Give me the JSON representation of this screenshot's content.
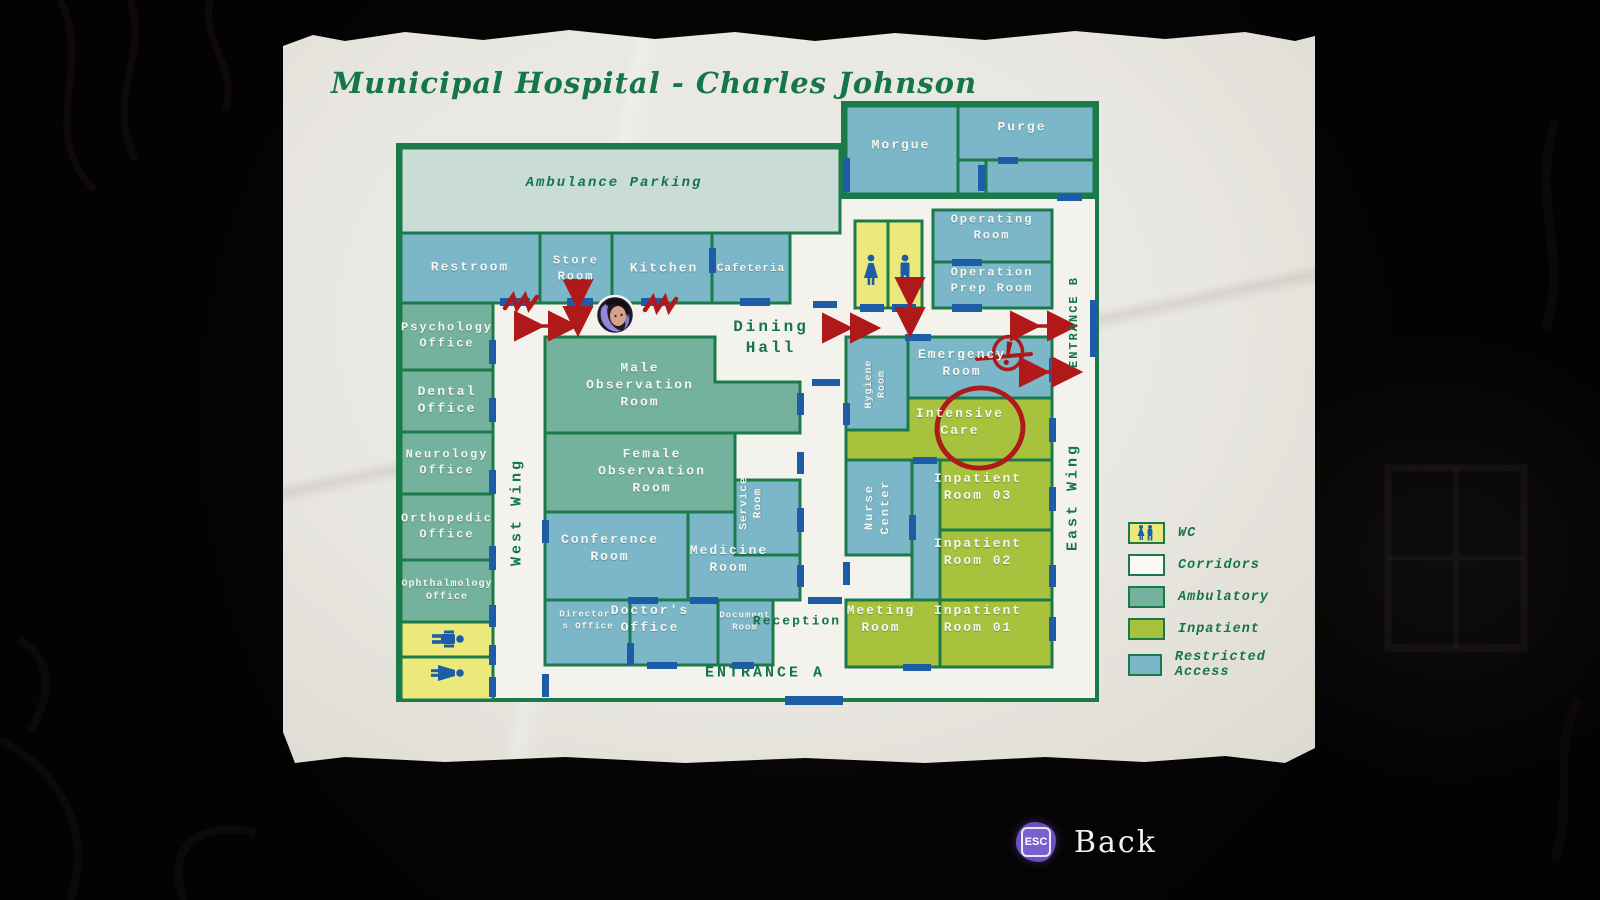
{
  "title": "Municipal Hospital - Charles Johnson",
  "map": {
    "ambulance_parking": "Ambulance Parking",
    "restroom": "Restroom",
    "store_room": "Store\nRoom",
    "kitchen": "Kitchen",
    "cafeteria": "Cafeteria",
    "psychology": "Psychology\nOffice",
    "dental": "Dental\nOffice",
    "neurology": "Neurology\nOffice",
    "orthopedic": "Orthopedic\nOffice",
    "ophthalmology": "Ophthalmology\nOffice",
    "west_wing": "West Wing",
    "male_observation": "Male\nObservation\nRoom",
    "female_observation": "Female\nObservation\nRoom",
    "service_room": "Service\nRoom",
    "conference": "Conference\nRoom",
    "medicine": "Medicine\nRoom",
    "directors_office": "Director'\ns Office",
    "doctors_office": "Doctor's\nOffice",
    "document_room": "Document\nRoom",
    "reception": "Reception",
    "dining_hall": "Dining\nHall",
    "morgue": "Morgue",
    "purge": "Purge",
    "operating_room": "Operating\nRoom",
    "operation_prep": "Operation\nPrep Room",
    "hygiene": "Hygiene\nRoom",
    "emergency": "Emergency\nRoom",
    "intensive_care": "Intensive\nCare",
    "nurse_center": "Nurse\nCenter",
    "inpatient_03": "Inpatient\nRoom 03",
    "inpatient_02": "Inpatient\nRoom 02",
    "inpatient_01": "Inpatient\nRoom 01",
    "meeting_room": "Meeting\nRoom",
    "east_wing": "East Wing",
    "entrance_a": "ENTRANCE A",
    "entrance_b": "ENTRANCE B"
  },
  "legend": {
    "items": [
      {
        "label": "WC"
      },
      {
        "label": "Corridors"
      },
      {
        "label": "Ambulatory"
      },
      {
        "label": "Inpatient"
      },
      {
        "label": "Restricted Access"
      }
    ]
  },
  "back": {
    "key": "ESC",
    "label": "Back"
  },
  "palette": {
    "paper": "#e9e7e1",
    "wall": "#1c7a4a",
    "corridor": "#f3f2ec",
    "restricted": "#7cb7c9",
    "ambulatory": "#74b29d",
    "inpatient": "#a8c23e",
    "wc": "#ece97c",
    "parking": "#c9dcd5",
    "door": "#1d5ca6",
    "text_green": "#15754a",
    "room_text": "#f7f6f1",
    "annotation_red": "#b01919",
    "accent_purple": "#7a5fce"
  }
}
